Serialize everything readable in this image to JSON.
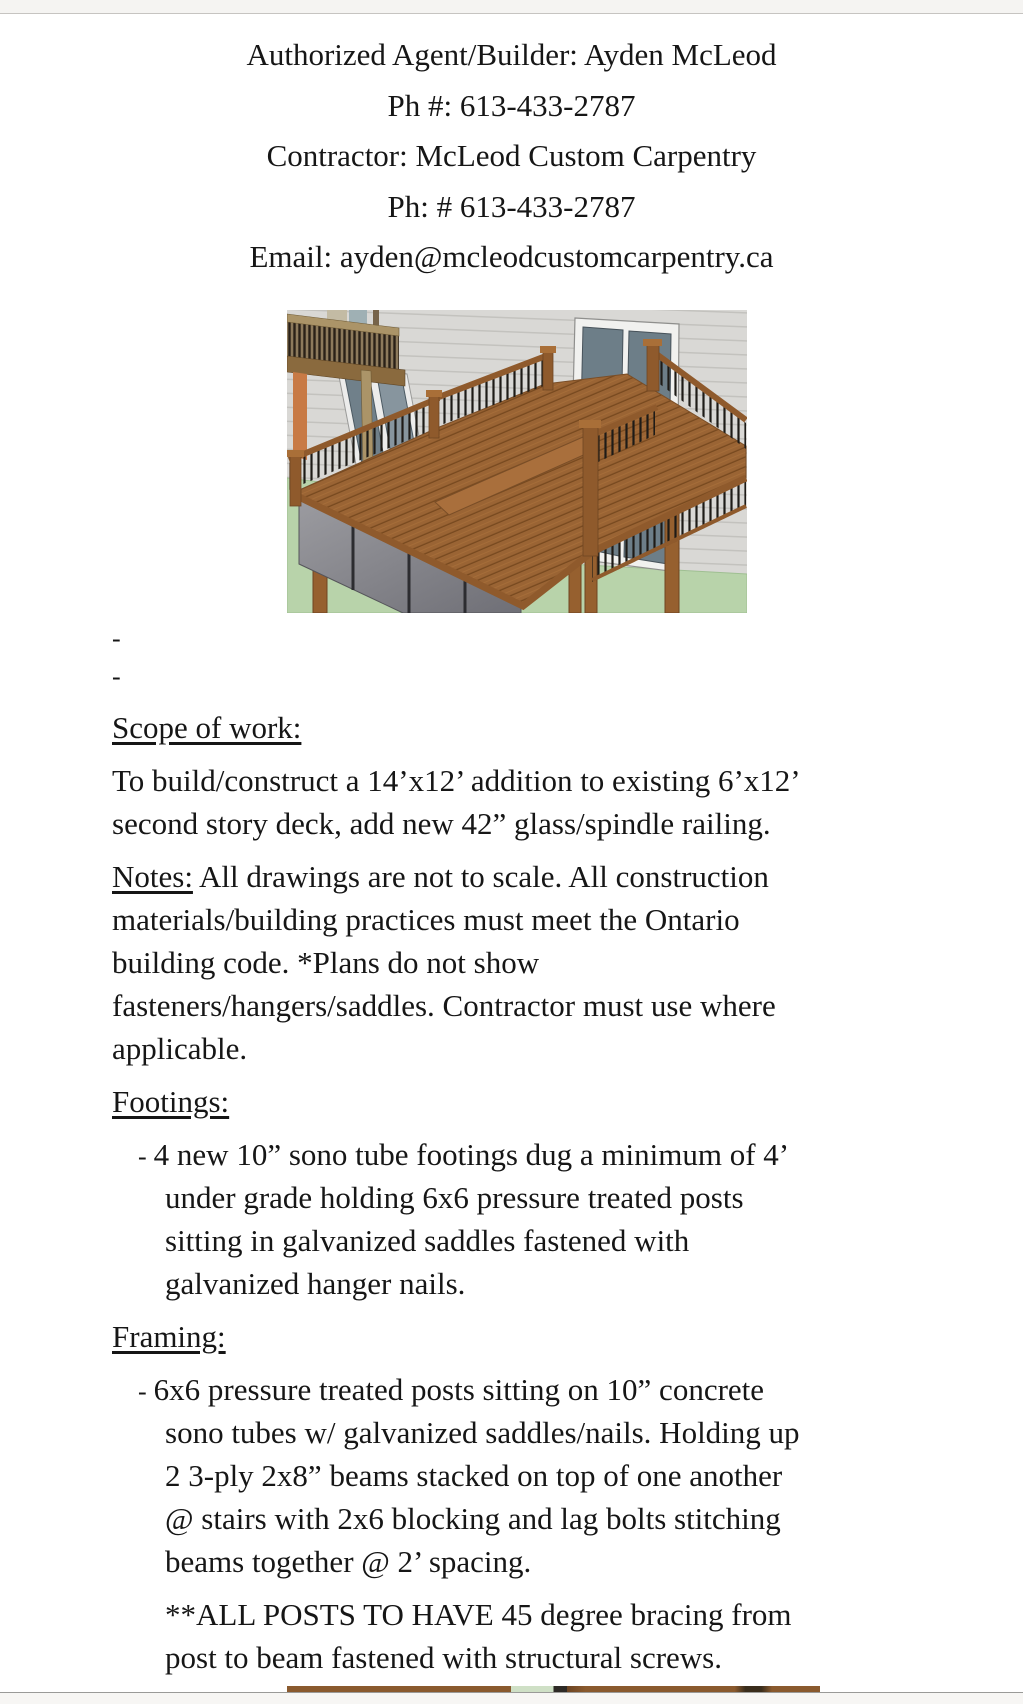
{
  "header": {
    "lines": [
      "Authorized Agent/Builder: Ayden McLeod",
      "Ph #: 613-433-2787",
      "Contractor: McLeod Custom Carpentry",
      "Ph: # 613-433-2787",
      "Email: ayden@mcleodcustomcarpentry.ca"
    ]
  },
  "figure": {
    "alt": "3D rendering of a second-story wood deck addition with glass and spindle railing against a grey-sided house, patio doors and green lawn below"
  },
  "doc": {
    "spacers": [
      "-",
      "-"
    ],
    "scope": {
      "heading": "Scope of work:",
      "lines": [
        "To build/construct a 14’x12’ addition to existing 6’x12’",
        "second story deck, add new 42” glass/spindle railing."
      ]
    },
    "notes": {
      "label": "Notes:",
      "after_label": " All drawings are not to scale. All construction",
      "lines": [
        "materials/building practices must meet the Ontario",
        "building code. *Plans do not show",
        "fasteners/hangers/saddles. Contractor must use where",
        "applicable."
      ]
    },
    "footings": {
      "heading": "Footings:",
      "bullet": "-",
      "first_line": "4 new 10” sono tube footings dug a minimum of 4’",
      "wrapped_lines": [
        "under grade holding 6x6 pressure treated posts",
        "sitting in galvanized saddles fastened with",
        "galvanized hanger nails."
      ]
    },
    "framing": {
      "heading": "Framing:",
      "bullet": "-",
      "first_line": "6x6 pressure treated posts sitting on 10” concrete",
      "wrapped_lines": [
        "sono tubes w/ galvanized saddles/nails. Holding up",
        "2 3-ply 2x8” beams stacked on top of one another",
        "@ stairs with 2x6 blocking and lag bolts stitching",
        "beams together @ 2’ spacing."
      ]
    },
    "posts_note": {
      "lines": [
        "**ALL POSTS TO HAVE 45 degree bracing from",
        "post to beam fastened with structural screws."
      ]
    }
  },
  "colors": {
    "page_bg": "#ffffff",
    "text": "#161616",
    "chrome_bar": "#f5f4f2",
    "siding_grey": "#d9d8d5",
    "lawn_green": "#b8d3aa",
    "deck_wood": "#9a6434",
    "railing_wood": "#8f5a2c",
    "spindle_black": "#1e1b17",
    "door_glass": "#6d7e88",
    "door_frame": "#f1f1ef",
    "balcony_tan": "#ab9468",
    "accent_orange": "#c87a45"
  }
}
